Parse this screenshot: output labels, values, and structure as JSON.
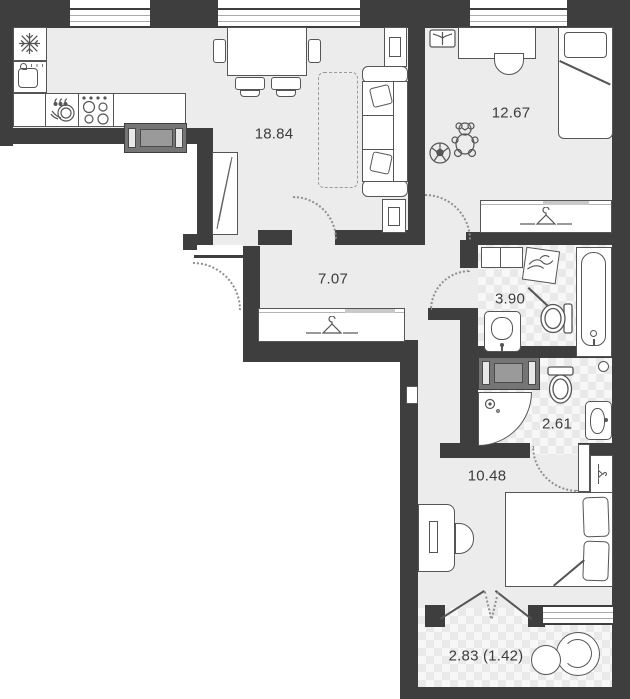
{
  "plan": {
    "rooms": [
      {
        "key": "living_kitchen",
        "label": "18.84"
      },
      {
        "key": "children_room",
        "label": "12.67"
      },
      {
        "key": "hallway",
        "label": "7.07"
      },
      {
        "key": "bathroom",
        "label": "3.90"
      },
      {
        "key": "shower_wc",
        "label": "2.61"
      },
      {
        "key": "bedroom",
        "label": "10.48"
      },
      {
        "key": "balcony",
        "label": "2.83 (1.42)"
      }
    ],
    "colors": {
      "wall": "#3e3e3e",
      "floor": "#ececec",
      "tile_base": "#f7f7f7",
      "tile_diamond": "#e9e9e9",
      "line": "#555555",
      "label": "#3c3c3c",
      "appliance_dark": "#757575",
      "appliance_mid": "#9a9a9a",
      "white": "#ffffff"
    }
  }
}
